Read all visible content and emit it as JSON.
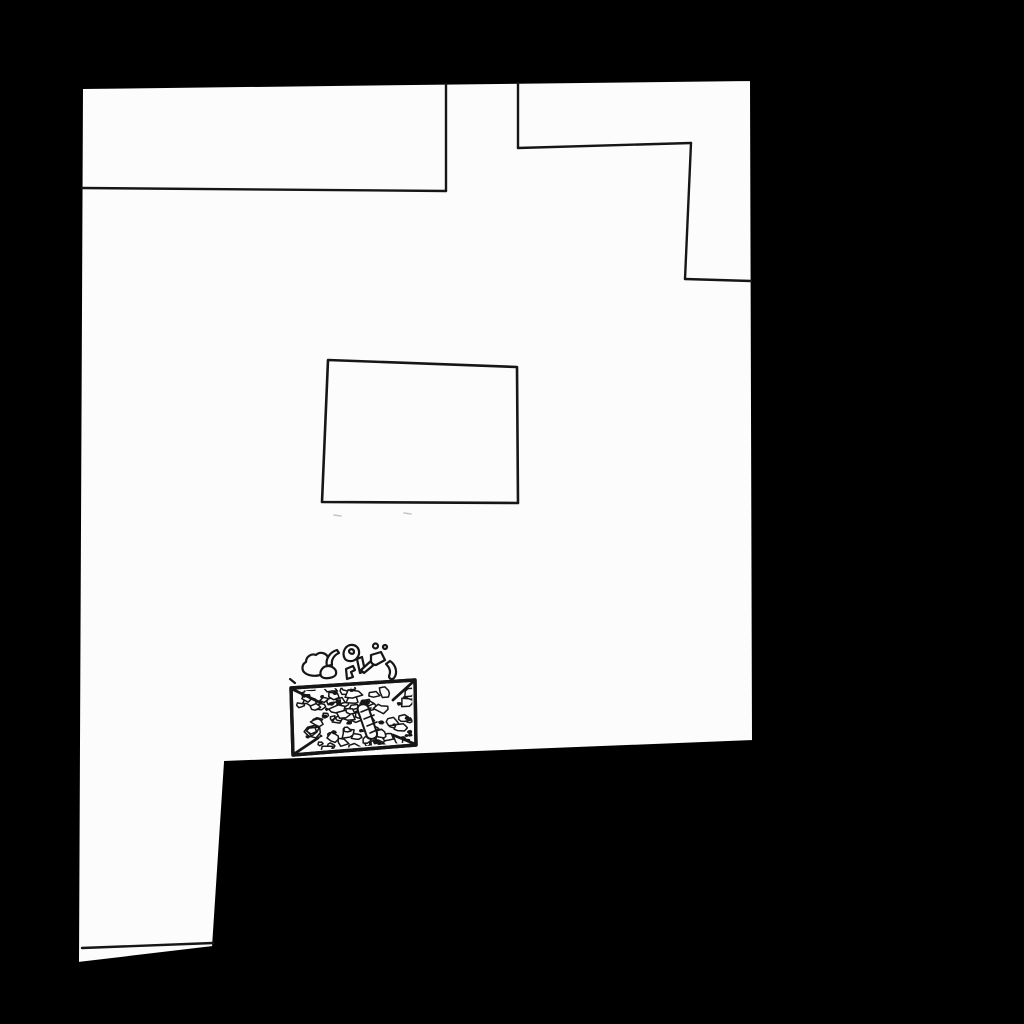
{
  "scene": {
    "description": "Hand-drawn top-down room map: white floor on black void, interior walls, a table rectangle, and a crate full of rubble with scattered debris",
    "background_color": "#000000",
    "floor_color": "#fcfcfc",
    "ink_color": "#161616",
    "faint_color": "#c4c4c4"
  },
  "floor": {
    "points": "82,88 751,80 753,741 225,762 213,947 78,963"
  },
  "walls": [
    {
      "name": "top-left-alcove-south-wall",
      "points": "82,188 446,191"
    },
    {
      "name": "top-left-alcove-east-wall",
      "points": "446,84 446,191"
    },
    {
      "name": "top-right-alcove-west-wall",
      "points": "518,83 518,148"
    },
    {
      "name": "top-right-alcove-south-wall",
      "points": "518,148 691,143"
    },
    {
      "name": "top-right-alcove-inner-east-wall",
      "points": "691,143 685,279"
    },
    {
      "name": "top-right-alcove-lower-south-wall",
      "points": "685,279 751,281"
    },
    {
      "name": "bottom-left-wall",
      "points": "82,948 213,943"
    }
  ],
  "table": {
    "points": "328,360 517,367 518,503 322,502"
  },
  "faint_marks": [
    {
      "points": "334,515 341,516"
    },
    {
      "points": "404,513 411,514"
    }
  ],
  "debris_box": {
    "outer_points": "291,688 415,680 416,745 293,755",
    "clip_points": "295,691 412,683 413,742 296,752",
    "corner_bevels": [
      "292,689 321,703",
      "414,681 393,700",
      "415,744 393,735",
      "294,754 318,738"
    ],
    "rubble": {
      "seed": 13,
      "count": 78,
      "bounds": [
        298,
        687,
        411,
        751
      ],
      "min_radius": 2.5,
      "max_radius": 7.5
    },
    "crevices": {
      "seed": 29,
      "count": 26,
      "min_radius": 1.0,
      "max_radius": 2.6
    },
    "hatched_shard": {
      "outline": "M360,705 c4,-2 8,0 9,4 l8,24 c1,5 -6,8 -10,4 l-9,-26 c-1,-3 0,-5 2,-6 z",
      "stripes": [
        "361,712 371,708",
        "364,719 374,715",
        "367,726 377,722",
        "370,733 379,729"
      ]
    }
  },
  "debris_scatter": [
    {
      "name": "pebble-large",
      "d": "M305,673 c-4,-3 -3,-9 1,-11 c0,-5 5,-9 10,-7 c4,-4 11,-2 12,3 c4,2 4,8 1,10 c1,4 -3,7 -7,6 c-5,3 -13,2 -17,-1 z"
    },
    {
      "name": "pebble-small",
      "d": "M321,676 c-2,-5 2,-10 7,-10 c5,0 9,4 8,8 c-1,4 -12,6 -15,2 z"
    },
    {
      "name": "shard-crescent-left",
      "d": "M337,650 c-7,2 -12,9 -10,16 l5,-1 c-1,-5 2,-10 7,-12 z"
    },
    {
      "name": "ring-piece",
      "d": "M345,659 c-4,-7 1,-15 8,-14 c6,1 8,8 4,13 c-3,4 -9,4 -12,1 z M349,651 c1,-3 5,-2 5,1 c0,3 -5,2 -5,-1 z"
    },
    {
      "name": "bent-bracket",
      "d": "M346,669 l7,-3 l2,4 l-4,2 l2,5 l-6,2 z"
    },
    {
      "name": "stick",
      "d": "M357,659 l5,-2 l3,14 l-5,2 z"
    },
    {
      "name": "axe-handle",
      "d": "M364,673 l-3,-3 l11,-10 l4,3 z"
    },
    {
      "name": "axe-head",
      "d": "M371,655 l10,-3 l4,8 l-9,5 c-3,0 -5,-2 -5,-4 z"
    },
    {
      "name": "shard-crescent-right",
      "d": "M390,661 c6,4 8,12 4,17 c-2,2 -5,1 -5,-2 c2,-4 1,-8 -3,-12 z"
    },
    {
      "name": "tiny-circle-1",
      "d": "M373,646 a2.5,2.5 0 1,0 5,0 a2.5,2.5 0 1,0 -5,0 z"
    },
    {
      "name": "tiny-circle-2",
      "d": "M383,647 a2,2 0 1,0 4,0 a2,2 0 1,0 -4,0 z"
    },
    {
      "name": "corner-tick",
      "d": "M290,679 l5,4"
    }
  ]
}
